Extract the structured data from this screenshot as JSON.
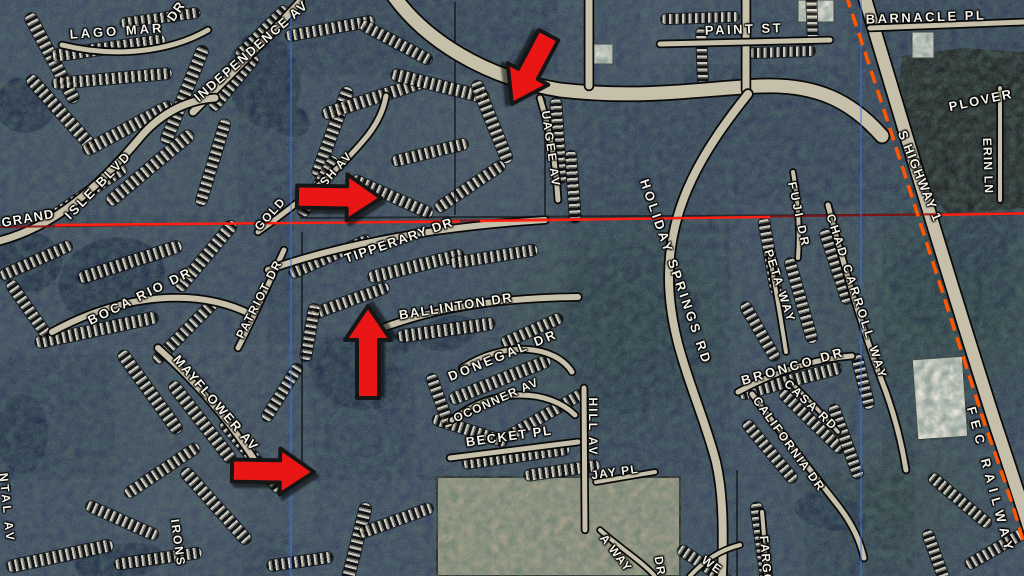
{
  "map": {
    "colors": {
      "background": "#1d2949",
      "label_text": "#f4f1e6",
      "arrow_fill": "#ea1515",
      "arrow_outline": "#161616",
      "section_line_dark": "#8d1010",
      "section_line_bright": "#ff2214",
      "grid_line_blue": "#3a72e6",
      "railway_orange": "#ff5603",
      "road_fill": "#c6c0aa",
      "road_casing": "#0a0a0a",
      "water": "#0c1838",
      "dark_area": "#06080c",
      "building": "#e6e3da",
      "field_tan": "#9b957e",
      "region_tint": "#55607a"
    },
    "street_labels": [
      {
        "text": "LAGO MAR",
        "x": 117,
        "y": 31,
        "r": -4,
        "ls": 3
      },
      {
        "text": "INDEPENDENCE AV",
        "x": 251,
        "y": 51,
        "r": -41,
        "ls": 1.5
      },
      {
        "text": "DR",
        "x": 176,
        "y": 11,
        "r": -55
      },
      {
        "text": "GRAND",
        "x": 28,
        "y": 218,
        "r": -10
      },
      {
        "text": "ISLE BLVD",
        "x": 98,
        "y": 185,
        "r": -46,
        "ls": 2.5
      },
      {
        "text": "BOCA RIO DR",
        "x": 140,
        "y": 296,
        "r": -26,
        "ls": 2.5
      },
      {
        "text": "PATRIOT DR",
        "x": 259,
        "y": 299,
        "r": -63,
        "ls": 1.5,
        "s": 12
      },
      {
        "text": "GOLD",
        "x": 270,
        "y": 214,
        "r": -48,
        "s": 12
      },
      {
        "text": "SH AV",
        "x": 336,
        "y": 169,
        "r": -48,
        "s": 12
      },
      {
        "text": "TIPPERARY DR",
        "x": 399,
        "y": 240,
        "r": -19,
        "ls": 1.5
      },
      {
        "text": "BALLINTON DR",
        "x": 456,
        "y": 306,
        "r": -9,
        "ls": 1.5
      },
      {
        "text": "DONEGAL DR",
        "x": 503,
        "y": 355,
        "r": -22,
        "ls": 3
      },
      {
        "text": "OCONNER AV",
        "x": 496,
        "y": 400,
        "r": -24,
        "s": 12
      },
      {
        "text": "BECKET PL",
        "x": 509,
        "y": 436,
        "r": -8,
        "ls": 1.5
      },
      {
        "text": "JAY PL",
        "x": 615,
        "y": 472,
        "r": -8,
        "s": 12
      },
      {
        "text": "HILL AV",
        "x": 593,
        "y": 427,
        "r": 90,
        "ls": 2,
        "s": 12
      },
      {
        "text": "MAYFLOWER AV",
        "x": 216,
        "y": 403,
        "r": 49,
        "ls": 1.5
      },
      {
        "text": "NTAL AV",
        "x": 7,
        "y": 508,
        "r": 84,
        "ls": 3,
        "s": 12
      },
      {
        "text": "IRONS",
        "x": 178,
        "y": 543,
        "r": 82,
        "ls": 2,
        "s": 12
      },
      {
        "text": "UAGEE AV",
        "x": 551,
        "y": 149,
        "r": 82,
        "ls": 2,
        "s": 12
      },
      {
        "text": "PAINT ST",
        "x": 744,
        "y": 29,
        "r": -2,
        "ls": 2.5
      },
      {
        "text": "BARNACLE PL",
        "x": 926,
        "y": 17,
        "r": -2,
        "ls": 2.5
      },
      {
        "text": "PLOVER",
        "x": 981,
        "y": 100,
        "r": -12,
        "ls": 2
      },
      {
        "text": "ERIN LN",
        "x": 988,
        "y": 166,
        "r": 88,
        "s": 12
      },
      {
        "text": "S HIGHWAY 1",
        "x": 920,
        "y": 176,
        "r": 68
      },
      {
        "text": "HOLIDAY SPRINGS RD",
        "x": 676,
        "y": 272,
        "r": 71,
        "ls": 3
      },
      {
        "text": "FUJI DR",
        "x": 799,
        "y": 215,
        "r": 78,
        "ls": 3,
        "s": 12
      },
      {
        "text": "PETA WAY",
        "x": 780,
        "y": 286,
        "r": 72,
        "ls": 2,
        "s": 12
      },
      {
        "text": "CHAD CARROLL WAY",
        "x": 857,
        "y": 297,
        "r": 72,
        "ls": 3,
        "s": 12
      },
      {
        "text": "BRONCO DR",
        "x": 793,
        "y": 366,
        "r": -16,
        "ls": 3
      },
      {
        "text": "CASA RD",
        "x": 811,
        "y": 405,
        "r": 43,
        "ls": 2,
        "s": 12
      },
      {
        "text": "CALIFORNIA DR",
        "x": 789,
        "y": 444,
        "r": 54,
        "ls": 1.5,
        "s": 12
      },
      {
        "text": "FEC RAILWAY",
        "x": 991,
        "y": 481,
        "r": 75,
        "ls": 6
      },
      {
        "text": "A WAY",
        "x": 616,
        "y": 553,
        "r": 52,
        "s": 12
      },
      {
        "text": "DR",
        "x": 660,
        "y": 566,
        "r": 80,
        "s": 12
      },
      {
        "text": "WE",
        "x": 712,
        "y": 565,
        "r": 35,
        "s": 12
      },
      {
        "text": "FARGO",
        "x": 766,
        "y": 560,
        "r": 85,
        "s": 12
      }
    ],
    "annotation_arrows": [
      {
        "x": 512,
        "y": 104,
        "angle": 118,
        "len": 78
      },
      {
        "x": 381,
        "y": 198,
        "angle": 1,
        "len": 84
      },
      {
        "x": 368,
        "y": 306,
        "angle": -90,
        "len": 92
      },
      {
        "x": 314,
        "y": 472,
        "angle": 1,
        "len": 82
      }
    ],
    "overlay_lines": {
      "red_base": "M 0,227 L 1024,213",
      "red_bright": [
        "M 55,225 L 460,221.5",
        "M 480,221 L 770,217",
        "M 930,215 L 1024,213.5"
      ],
      "blue_vertical": [
        "M 291,15 L 291,576",
        "M 861,0 L 861,576"
      ],
      "railway": "M 846,-5 C 888,120 932,260 985,425 C 1002,472 1022,530 1032,576"
    },
    "regions": [
      [
        0,
        0,
        238,
        215
      ],
      [
        0,
        225,
        268,
        130
      ],
      [
        295,
        75,
        262,
        150
      ],
      [
        295,
        225,
        272,
        112
      ],
      [
        415,
        335,
        178,
        140
      ],
      [
        115,
        345,
        198,
        188
      ],
      [
        0,
        480,
        242,
        96
      ],
      [
        288,
        480,
        152,
        96
      ],
      [
        730,
        205,
        152,
        268
      ],
      [
        675,
        475,
        130,
        101
      ],
      [
        640,
        0,
        208,
        64
      ],
      [
        915,
        440,
        109,
        136
      ],
      [
        558,
        0,
        125,
        88
      ]
    ],
    "water": [
      [
        264,
        80,
        36,
        48,
        -10,
        1
      ],
      [
        289,
        120,
        22,
        16,
        20,
        1
      ],
      [
        25,
        105,
        30,
        28,
        0,
        1
      ],
      [
        28,
        262,
        34,
        30,
        0,
        1
      ],
      [
        112,
        280,
        54,
        42,
        -15,
        1
      ],
      [
        355,
        374,
        48,
        34,
        22,
        1
      ],
      [
        398,
        340,
        20,
        14,
        0,
        1
      ],
      [
        448,
        333,
        30,
        17,
        -14,
        1
      ],
      [
        22,
        434,
        26,
        40,
        0,
        1
      ],
      [
        120,
        562,
        46,
        18,
        -8,
        1
      ],
      [
        1010,
        78,
        22,
        20,
        0,
        1
      ],
      [
        952,
        284,
        62,
        50,
        0,
        0.45
      ],
      [
        632,
        330,
        72,
        84,
        0,
        0.5
      ],
      [
        830,
        512,
        36,
        18,
        10,
        0.85
      ],
      [
        980,
        242,
        42,
        26,
        -30,
        0.5
      ]
    ],
    "commercial_dark_area": {
      "points": "902,56 962,48 1024,52 1024,208 948,214 912,172 896,110"
    },
    "field": [
      437,
      477,
      243,
      99
    ],
    "buildings": [
      [
        915,
        358,
        50,
        80,
        -4
      ],
      [
        798,
        0,
        36,
        22,
        0
      ],
      [
        912,
        32,
        22,
        26,
        0
      ],
      [
        585,
        44,
        28,
        20,
        0
      ]
    ],
    "boundary_lines": [
      "M 302,232 L 302,470",
      "M 455,2 L 455,215",
      "M 545,98 L 545,215",
      "M 300,218 L 1024,214",
      "M 737,470 L 737,576"
    ],
    "roads": [
      {
        "d": "M 393,-5 C 425,40 485,78 560,90 C 645,100 705,88 762,86 C 818,84 852,102 882,136",
        "w": 13
      },
      {
        "d": "M 589,0 L 589,86",
        "w": 7
      },
      {
        "d": "M 746,0 L 746,90",
        "w": 7
      },
      {
        "d": "M 660,44 L 830,40",
        "w": 5
      },
      {
        "d": "M 748,94 C 705,148 668,205 669,280 C 670,348 700,400 716,462 C 722,488 724,520 722,576",
        "w": 8
      },
      {
        "d": "M 864,-5 C 900,115 940,250 994,420 C 1010,468 1030,528 1044,576",
        "w": 12
      },
      {
        "d": "M 193,112 C 230,75 265,40 300,2",
        "w": 7
      },
      {
        "d": "M -5,242 C 55,228 100,185 138,140 C 158,115 185,100 215,98",
        "w": 7
      },
      {
        "d": "M 62,45 C 115,58 170,52 208,30",
        "w": 5
      },
      {
        "d": "M 52,332 C 125,292 200,288 252,315",
        "w": 6
      },
      {
        "d": "M 238,348 C 255,315 270,280 284,250",
        "w": 5
      },
      {
        "d": "M 268,270 C 330,248 420,228 545,220",
        "w": 6
      },
      {
        "d": "M 258,232 C 300,202 340,170 368,135 C 378,122 384,108 386,96",
        "w": 5
      },
      {
        "d": "M 372,332 C 440,305 505,298 578,297",
        "w": 6
      },
      {
        "d": "M 462,368 C 505,340 555,345 572,372",
        "w": 5
      },
      {
        "d": "M 452,420 C 495,385 550,390 575,415",
        "w": 5
      },
      {
        "d": "M 450,458 L 578,442",
        "w": 5
      },
      {
        "d": "M 584,388 L 585,530",
        "w": 5
      },
      {
        "d": "M 596,482 L 655,472",
        "w": 4
      },
      {
        "d": "M 158,348 C 205,390 240,435 262,472",
        "w": 6
      },
      {
        "d": "M 540,98 C 550,130 556,165 558,200",
        "w": 5
      },
      {
        "d": "M 828,205 C 843,262 862,330 886,392 C 896,420 902,445 906,470",
        "w": 5
      },
      {
        "d": "M 793,172 C 798,200 800,230 798,258",
        "w": 4
      },
      {
        "d": "M 770,258 C 776,290 781,320 786,352",
        "w": 4
      },
      {
        "d": "M 738,392 C 782,368 822,358 852,356",
        "w": 5
      },
      {
        "d": "M 752,394 C 780,432 812,472 840,508 C 852,524 860,540 864,558",
        "w": 5
      },
      {
        "d": "M 600,530 C 620,548 640,560 655,576",
        "w": 4
      },
      {
        "d": "M 762,512 C 764,535 766,556 766,576",
        "w": 4
      },
      {
        "d": "M 690,576 C 705,560 720,550 740,545",
        "w": 4
      },
      {
        "d": "M 1000,88 L 1000,200",
        "w": 4
      },
      {
        "d": "M 870,28 L 1024,22",
        "w": 5
      },
      {
        "d": "M 790,382 C 808,398 824,416 838,432",
        "w": 3.5
      }
    ],
    "parcel_strips": [
      [
        52,
        58,
        100,
        62,
        12
      ],
      [
        108,
        48,
        115,
        -8,
        12
      ],
      [
        112,
        78,
        120,
        -5,
        11
      ],
      [
        60,
        112,
        95,
        48,
        12
      ],
      [
        128,
        128,
        100,
        -28,
        12
      ],
      [
        184,
        95,
        105,
        -68,
        12
      ],
      [
        150,
        168,
        110,
        -40,
        12
      ],
      [
        213,
        162,
        90,
        -73,
        11
      ],
      [
        88,
        192,
        90,
        -34,
        11
      ],
      [
        160,
        18,
        80,
        -8,
        10
      ],
      [
        262,
        32,
        70,
        -45,
        11
      ],
      [
        234,
        82,
        70,
        -50,
        11
      ],
      [
        330,
        28,
        90,
        -10,
        11
      ],
      [
        396,
        42,
        80,
        28,
        11
      ],
      [
        332,
        132,
        95,
        -70,
        12
      ],
      [
        374,
        98,
        108,
        -18,
        12
      ],
      [
        440,
        86,
        100,
        14,
        12
      ],
      [
        492,
        122,
        88,
        68,
        12
      ],
      [
        430,
        152,
        78,
        -14,
        11
      ],
      [
        392,
        196,
        88,
        24,
        11
      ],
      [
        470,
        186,
        82,
        -34,
        11
      ],
      [
        318,
        186,
        68,
        -60,
        11
      ],
      [
        558,
        140,
        85,
        86,
        11
      ],
      [
        573,
        186,
        72,
        86,
        11
      ],
      [
        36,
        260,
        78,
        -24,
        11
      ],
      [
        130,
        262,
        108,
        -18,
        12
      ],
      [
        206,
        256,
        88,
        -50,
        12
      ],
      [
        96,
        330,
        125,
        -12,
        12
      ],
      [
        186,
        330,
        88,
        -45,
        11
      ],
      [
        28,
        308,
        66,
        55,
        11
      ],
      [
        330,
        256,
        88,
        -24,
        11
      ],
      [
        416,
        266,
        98,
        -14,
        12
      ],
      [
        494,
        256,
        88,
        -9,
        11
      ],
      [
        350,
        300,
        82,
        -20,
        11
      ],
      [
        446,
        330,
        98,
        -8,
        12
      ],
      [
        532,
        330,
        66,
        -24,
        11
      ],
      [
        310,
        332,
        58,
        -80,
        11
      ],
      [
        500,
        380,
        108,
        -22,
        12
      ],
      [
        546,
        414,
        88,
        -30,
        11
      ],
      [
        470,
        430,
        78,
        18,
        11
      ],
      [
        516,
        456,
        108,
        -8,
        12
      ],
      [
        562,
        470,
        76,
        -8,
        11
      ],
      [
        440,
        400,
        56,
        70,
        11
      ],
      [
        150,
        392,
        100,
        54,
        12
      ],
      [
        202,
        422,
        100,
        52,
        12
      ],
      [
        252,
        456,
        92,
        50,
        12
      ],
      [
        162,
        470,
        88,
        -34,
        11
      ],
      [
        216,
        506,
        98,
        48,
        12
      ],
      [
        122,
        520,
        78,
        24,
        11
      ],
      [
        282,
        392,
        66,
        -58,
        11
      ],
      [
        60,
        556,
        108,
        -12,
        12
      ],
      [
        158,
        558,
        88,
        -8,
        11
      ],
      [
        356,
        546,
        88,
        -76,
        12
      ],
      [
        396,
        520,
        78,
        -20,
        11
      ],
      [
        300,
        561,
        66,
        -8,
        11
      ],
      [
        770,
        256,
        78,
        80,
        11
      ],
      [
        801,
        300,
        88,
        74,
        11
      ],
      [
        836,
        266,
        78,
        72,
        11
      ],
      [
        760,
        331,
        66,
        60,
        11
      ],
      [
        790,
        381,
        106,
        -15,
        12
      ],
      [
        812,
        421,
        86,
        44,
        11
      ],
      [
        770,
        451,
        78,
        50,
        11
      ],
      [
        846,
        441,
        78,
        70,
        11
      ],
      [
        863,
        381,
        56,
        76,
        11
      ],
      [
        762,
        546,
        88,
        82,
        12
      ],
      [
        706,
        566,
        66,
        34,
        11
      ],
      [
        700,
        18,
        78,
        -2,
        10
      ],
      [
        782,
        52,
        66,
        -2,
        10
      ],
      [
        702,
        56,
        56,
        88,
        10
      ],
      [
        812,
        16,
        56,
        88,
        10
      ],
      [
        960,
        500,
        78,
        40,
        11
      ],
      [
        1000,
        546,
        78,
        -30,
        11
      ],
      [
        936,
        556,
        56,
        70,
        11
      ]
    ]
  }
}
